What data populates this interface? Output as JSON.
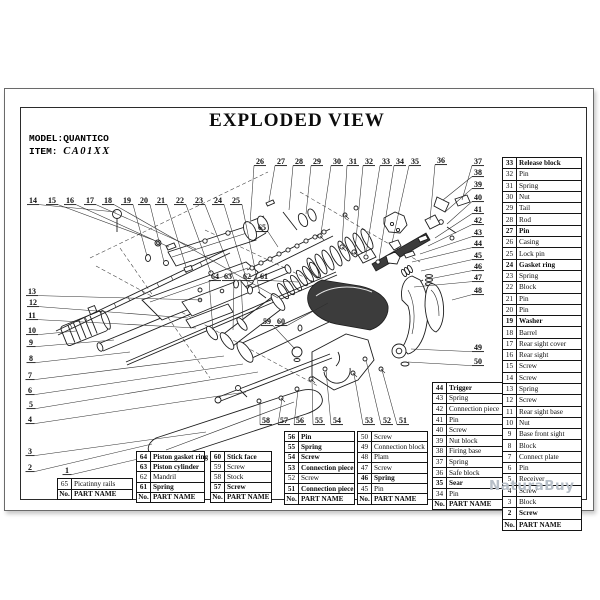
{
  "page": {
    "title": "EXPLODED VIEW",
    "model_label": "MODEL:QUANTICO",
    "item_label": "ITEM:",
    "item_value": "CA01XX",
    "watermark": "NaturaBuy"
  },
  "table_header": [
    "No.",
    "PART NAME"
  ],
  "tables": [
    {
      "name": "table-picatinny",
      "x": 57,
      "y": 478,
      "w": 76,
      "rh": 9.5,
      "rows": [
        [
          "65",
          "Picatinny rails",
          0
        ]
      ]
    },
    {
      "name": "table-61-64",
      "x": 136,
      "y": 451,
      "w": 69,
      "rh": 9.2,
      "rows": [
        [
          "64",
          "Piston gasket ring",
          1
        ],
        [
          "63",
          "Piston cylinder",
          1
        ],
        [
          "62",
          "Mandril",
          0
        ],
        [
          "61",
          "Spring",
          1
        ]
      ]
    },
    {
      "name": "table-57-60",
      "x": 210,
      "y": 451,
      "w": 62,
      "rh": 9.2,
      "rows": [
        [
          "60",
          "Stick face",
          1
        ],
        [
          "59",
          "Screw",
          0
        ],
        [
          "58",
          "Stock",
          0
        ],
        [
          "57",
          "Screw",
          1
        ]
      ]
    },
    {
      "name": "table-51-56",
      "x": 284,
      "y": 431,
      "w": 71,
      "rh": 9.4,
      "rows": [
        [
          "56",
          "Pin",
          1
        ],
        [
          "55",
          "Spring",
          1
        ],
        [
          "54",
          "Screw",
          1
        ],
        [
          "53",
          "Connection piece",
          1
        ],
        [
          "52",
          "Screw",
          0
        ],
        [
          "51",
          "Connection piece",
          1
        ]
      ]
    },
    {
      "name": "table-45-50",
      "x": 357,
      "y": 431,
      "w": 71,
      "rh": 9.4,
      "rows": [
        [
          "50",
          "Screw",
          0
        ],
        [
          "49",
          "Connection block",
          0
        ],
        [
          "48",
          "Plam",
          0
        ],
        [
          "47",
          "Screw",
          0
        ],
        [
          "46",
          "Spring",
          1
        ],
        [
          "45",
          "Pin",
          0
        ]
      ]
    },
    {
      "name": "table-34-44",
      "x": 432,
      "y": 382,
      "w": 71,
      "rh": 9.6,
      "rows": [
        [
          "44",
          "Trigger",
          1
        ],
        [
          "43",
          "Spring",
          0
        ],
        [
          "42",
          "Connection piece",
          0
        ],
        [
          "41",
          "Pin",
          0
        ],
        [
          "40",
          "Screw",
          0
        ],
        [
          "39",
          "Nut block",
          0
        ],
        [
          "38",
          "Firing base",
          0
        ],
        [
          "37",
          "Spring",
          0
        ],
        [
          "36",
          "Safe block",
          0
        ],
        [
          "35",
          "Sear",
          1
        ],
        [
          "34",
          "Pin",
          0
        ]
      ]
    },
    {
      "name": "table-2-33",
      "x": 502,
      "y": 157,
      "w": 80,
      "rh": 10.3,
      "rows": [
        [
          "33",
          "Release block",
          1
        ],
        [
          "32",
          "Pin",
          0
        ],
        [
          "31",
          "Spring",
          0
        ],
        [
          "30",
          "Nut",
          0
        ],
        [
          "29",
          "Tail",
          0
        ],
        [
          "28",
          "Rod",
          0
        ],
        [
          "27",
          "Pin",
          1
        ],
        [
          "26",
          "Casing",
          0
        ],
        [
          "25",
          "Lock pin",
          0
        ],
        [
          "24",
          "Gasket ring",
          1
        ],
        [
          "23",
          "Spring",
          0
        ],
        [
          "22",
          "Block",
          0
        ],
        [
          "21",
          "Pin",
          0
        ],
        [
          "20",
          "Pin",
          0
        ],
        [
          "19",
          "Washer",
          1
        ],
        [
          "18",
          "Barrel",
          0
        ],
        [
          "17",
          "Rear sight cover",
          0
        ],
        [
          "16",
          "Rear sight",
          0
        ],
        [
          "15",
          "Screw",
          0
        ],
        [
          "14",
          "Screw",
          0
        ],
        [
          "13",
          "Spring",
          0
        ],
        [
          "12",
          "Screw",
          0
        ],
        [
          "11",
          "Rear sight base",
          0
        ],
        [
          "10",
          "Nut",
          0
        ],
        [
          "9",
          "Base front sight",
          0
        ],
        [
          "8",
          "Block",
          0
        ],
        [
          "7",
          "Connect plate",
          0
        ],
        [
          "6",
          "Pin",
          0
        ],
        [
          "5",
          "Receiver",
          0
        ],
        [
          "4",
          "Screw",
          0
        ],
        [
          "3",
          "Block",
          0
        ],
        [
          "2",
          "Screw",
          1
        ]
      ]
    }
  ],
  "diagram": {
    "callouts": [
      [
        1,
        67,
        472,
        168,
        452
      ],
      [
        2,
        30,
        469,
        152,
        444
      ],
      [
        3,
        30,
        453,
        206,
        432
      ],
      [
        4,
        30,
        421,
        246,
        392
      ],
      [
        5,
        31,
        406,
        258,
        372
      ],
      [
        6,
        30,
        392,
        243,
        364
      ],
      [
        7,
        30,
        377,
        224,
        356
      ],
      [
        8,
        31,
        360,
        130,
        352
      ],
      [
        9,
        31,
        344,
        114,
        340
      ],
      [
        10,
        32,
        332,
        76,
        331
      ],
      [
        11,
        32,
        317,
        196,
        328
      ],
      [
        12,
        33,
        304,
        188,
        318
      ],
      [
        13,
        32,
        293,
        202,
        300
      ],
      [
        14,
        33,
        202,
        116,
        212
      ],
      [
        15,
        52,
        202,
        156,
        241
      ],
      [
        16,
        70,
        202,
        169,
        247
      ],
      [
        17,
        90,
        202,
        196,
        249
      ],
      [
        18,
        108,
        202,
        278,
        298
      ],
      [
        19,
        127,
        202,
        147,
        256
      ],
      [
        20,
        144,
        202,
        164,
        262
      ],
      [
        21,
        161,
        202,
        186,
        267
      ],
      [
        22,
        180,
        202,
        211,
        273
      ],
      [
        23,
        199,
        202,
        235,
        282
      ],
      [
        24,
        218,
        202,
        249,
        288
      ],
      [
        25,
        236,
        202,
        260,
        294
      ],
      [
        26,
        260,
        163,
        250,
        224
      ],
      [
        27,
        281,
        163,
        269,
        201
      ],
      [
        28,
        299,
        163,
        289,
        210
      ],
      [
        29,
        317,
        163,
        306,
        214
      ],
      [
        30,
        337,
        163,
        321,
        233
      ],
      [
        31,
        353,
        163,
        342,
        245
      ],
      [
        32,
        369,
        163,
        355,
        250
      ],
      [
        33,
        386,
        163,
        366,
        254
      ],
      [
        34,
        400,
        163,
        379,
        260
      ],
      [
        35,
        415,
        163,
        392,
        243
      ],
      [
        36,
        441,
        162,
        430,
        220
      ],
      [
        37,
        478,
        163,
        462,
        200
      ],
      [
        38,
        478,
        174,
        443,
        200
      ],
      [
        39,
        478,
        186,
        445,
        212
      ],
      [
        40,
        478,
        199,
        447,
        224
      ],
      [
        41,
        478,
        211,
        435,
        238
      ],
      [
        42,
        478,
        222,
        428,
        246
      ],
      [
        43,
        478,
        234,
        420,
        254
      ],
      [
        44,
        478,
        245,
        412,
        262
      ],
      [
        45,
        478,
        257,
        421,
        271
      ],
      [
        46,
        478,
        268,
        429,
        279
      ],
      [
        47,
        478,
        279,
        414,
        287
      ],
      [
        48,
        478,
        292,
        452,
        300
      ],
      [
        49,
        478,
        349,
        411,
        349
      ],
      [
        50,
        478,
        363,
        408,
        362
      ],
      [
        51,
        403,
        422,
        382,
        370
      ],
      [
        52,
        387,
        422,
        366,
        360
      ],
      [
        53,
        369,
        422,
        354,
        374
      ],
      [
        54,
        337,
        422,
        326,
        370
      ],
      [
        55,
        319,
        422,
        312,
        380
      ],
      [
        56,
        300,
        422,
        298,
        390
      ],
      [
        57,
        284,
        422,
        282,
        399
      ],
      [
        58,
        266,
        422,
        260,
        402
      ],
      [
        59,
        267,
        323,
        295,
        349
      ],
      [
        60,
        281,
        323,
        328,
        303
      ],
      [
        61,
        264,
        278,
        298,
        282
      ],
      [
        62,
        247,
        278,
        243,
        321
      ],
      [
        63,
        228,
        278,
        233,
        330
      ],
      [
        64,
        215,
        278,
        213,
        330
      ],
      [
        65,
        262,
        229,
        278,
        247
      ]
    ]
  }
}
